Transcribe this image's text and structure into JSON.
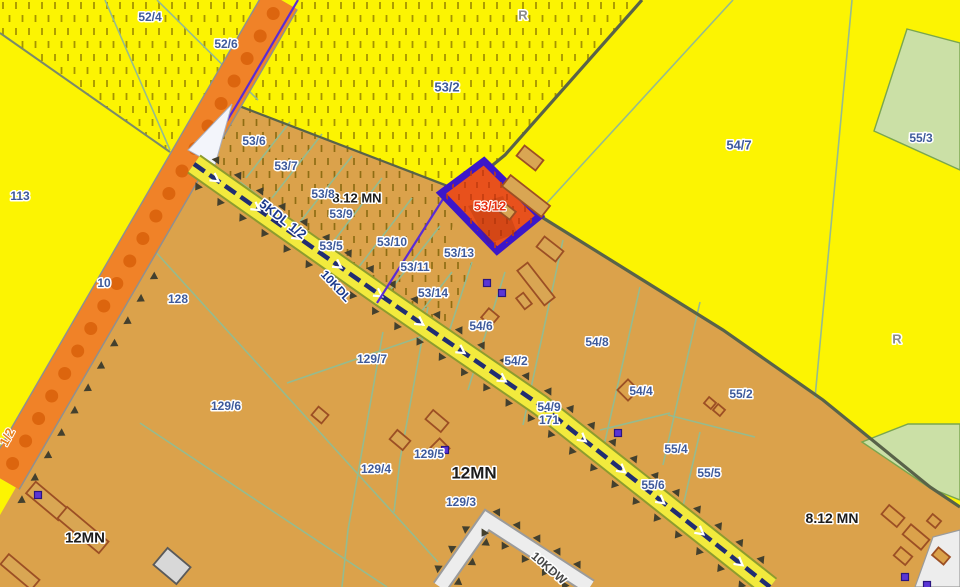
{
  "map": {
    "type": "cadastral-zoning-plan",
    "highlight": {
      "parcel": "53/12"
    },
    "colors": {
      "bg_yellow": "#fcf402",
      "hatch_yellow_dash": "#a59400",
      "tan": "#dba24b",
      "hatch_tan_dash": "#8f6d13",
      "hatch_red_dash": "#c23c0e",
      "green_area": "#cbe0a6",
      "green_edge": "#7aa64e",
      "orange_road": "#f08228",
      "orange_road_dot": "#dc650e",
      "road_casing": "#8f8f8f",
      "kdl_yellow": "#f2ea3d",
      "kdl_edge": "#8e9c2e",
      "kdl_navy": "#202d72",
      "white_road": "#ededed",
      "white_road_casing": "#9b9b9b",
      "boundary_dark": "#596349",
      "parcel_line": "#95bb8f",
      "plan_purple": "#5a2bd5",
      "highlight_fill": "#e8511c",
      "highlight_border": "#3c17c9",
      "building_outline": "#9c4f24",
      "building_fill": "#d9a653",
      "building_gray": "#d8d8d8",
      "building_gray_edge": "#5a5a5a",
      "tri_color": "#43402e",
      "square_symbol": "#5a35d5",
      "square_symbol_edge": "#2a1580",
      "wedge_white": "#f3f5fb",
      "label_blue": "#3e5a9b",
      "label_black": "#1c1c1c",
      "label_gray": "#8c8c8c",
      "label_red": "#e82e12",
      "label_orange": "#e8821c",
      "label_navy": "#1c3a8c",
      "label_dgray": "#474747"
    },
    "labels": [
      {
        "t": "8.12 MN",
        "x": 357,
        "y": 198,
        "c": "zone",
        "s": 13
      },
      {
        "t": "12MN",
        "x": 474,
        "y": 473,
        "c": "zone",
        "s": 17
      },
      {
        "t": "12MN",
        "x": 85,
        "y": 538,
        "c": "zone",
        "s": 15
      },
      {
        "t": "8.12 MN",
        "x": 832,
        "y": 518,
        "c": "zone",
        "s": 14
      },
      {
        "t": "R",
        "x": 523,
        "y": 15,
        "c": "marker",
        "s": 13
      },
      {
        "t": "R",
        "x": 897,
        "y": 339,
        "c": "marker",
        "s": 13
      },
      {
        "t": "5KDL 1/2",
        "x": 283,
        "y": 219,
        "c": "road",
        "s": 13,
        "r": 38
      },
      {
        "t": "10KDL",
        "x": 336,
        "y": 286,
        "c": "road",
        "s": 12,
        "r": 47
      },
      {
        "t": "10KDW",
        "x": 549,
        "y": 568,
        "c": "roadw",
        "s": 12,
        "r": 41
      },
      {
        "t": "1/2",
        "x": 7,
        "y": 437,
        "c": "edge",
        "s": 13,
        "r": -62
      },
      {
        "t": "52/4",
        "x": 150,
        "y": 17,
        "c": "parcel"
      },
      {
        "t": "52/6",
        "x": 226,
        "y": 44,
        "c": "parcel"
      },
      {
        "t": "53/2",
        "x": 447,
        "y": 87,
        "c": "parcel",
        "s": 13
      },
      {
        "t": "54/7",
        "x": 739,
        "y": 145,
        "c": "parcel",
        "s": 13
      },
      {
        "t": "55/3",
        "x": 921,
        "y": 138,
        "c": "parcel"
      },
      {
        "t": "113",
        "x": 20,
        "y": 196,
        "c": "parcel"
      },
      {
        "t": "10",
        "x": 104,
        "y": 283,
        "c": "parcel"
      },
      {
        "t": "53/6",
        "x": 254,
        "y": 141,
        "c": "parcel"
      },
      {
        "t": "53/7",
        "x": 286,
        "y": 166,
        "c": "parcel"
      },
      {
        "t": "53/8",
        "x": 323,
        "y": 194,
        "c": "parcel"
      },
      {
        "t": "53/9",
        "x": 341,
        "y": 214,
        "c": "parcel"
      },
      {
        "t": "53/5",
        "x": 331,
        "y": 246,
        "c": "parcel"
      },
      {
        "t": "53/10",
        "x": 392,
        "y": 242,
        "c": "parcel"
      },
      {
        "t": "53/11",
        "x": 415,
        "y": 267,
        "c": "parcel"
      },
      {
        "t": "53/13",
        "x": 459,
        "y": 253,
        "c": "parcel"
      },
      {
        "t": "53/14",
        "x": 433,
        "y": 293,
        "c": "parcel"
      },
      {
        "t": "54/6",
        "x": 481,
        "y": 326,
        "c": "parcel"
      },
      {
        "t": "54/2",
        "x": 516,
        "y": 361,
        "c": "parcel"
      },
      {
        "t": "54/8",
        "x": 597,
        "y": 342,
        "c": "parcel"
      },
      {
        "t": "54/4",
        "x": 641,
        "y": 391,
        "c": "parcel"
      },
      {
        "t": "54/9",
        "x": 549,
        "y": 407,
        "c": "parcel"
      },
      {
        "t": "171",
        "x": 549,
        "y": 420,
        "c": "parcel"
      },
      {
        "t": "55/2",
        "x": 741,
        "y": 394,
        "c": "parcel"
      },
      {
        "t": "55/4",
        "x": 676,
        "y": 449,
        "c": "parcel"
      },
      {
        "t": "55/5",
        "x": 709,
        "y": 473,
        "c": "parcel"
      },
      {
        "t": "55/6",
        "x": 653,
        "y": 485,
        "c": "parcel"
      },
      {
        "t": "128",
        "x": 178,
        "y": 299,
        "c": "parcel"
      },
      {
        "t": "129/6",
        "x": 226,
        "y": 406,
        "c": "parcel"
      },
      {
        "t": "129/7",
        "x": 372,
        "y": 359,
        "c": "parcel"
      },
      {
        "t": "129/4",
        "x": 376,
        "y": 469,
        "c": "parcel"
      },
      {
        "t": "129/5",
        "x": 429,
        "y": 454,
        "c": "parcel"
      },
      {
        "t": "129/3",
        "x": 461,
        "y": 502,
        "c": "parcel"
      },
      {
        "t": "53/12",
        "x": 490,
        "y": 206,
        "c": "highlight",
        "s": 13
      }
    ]
  }
}
